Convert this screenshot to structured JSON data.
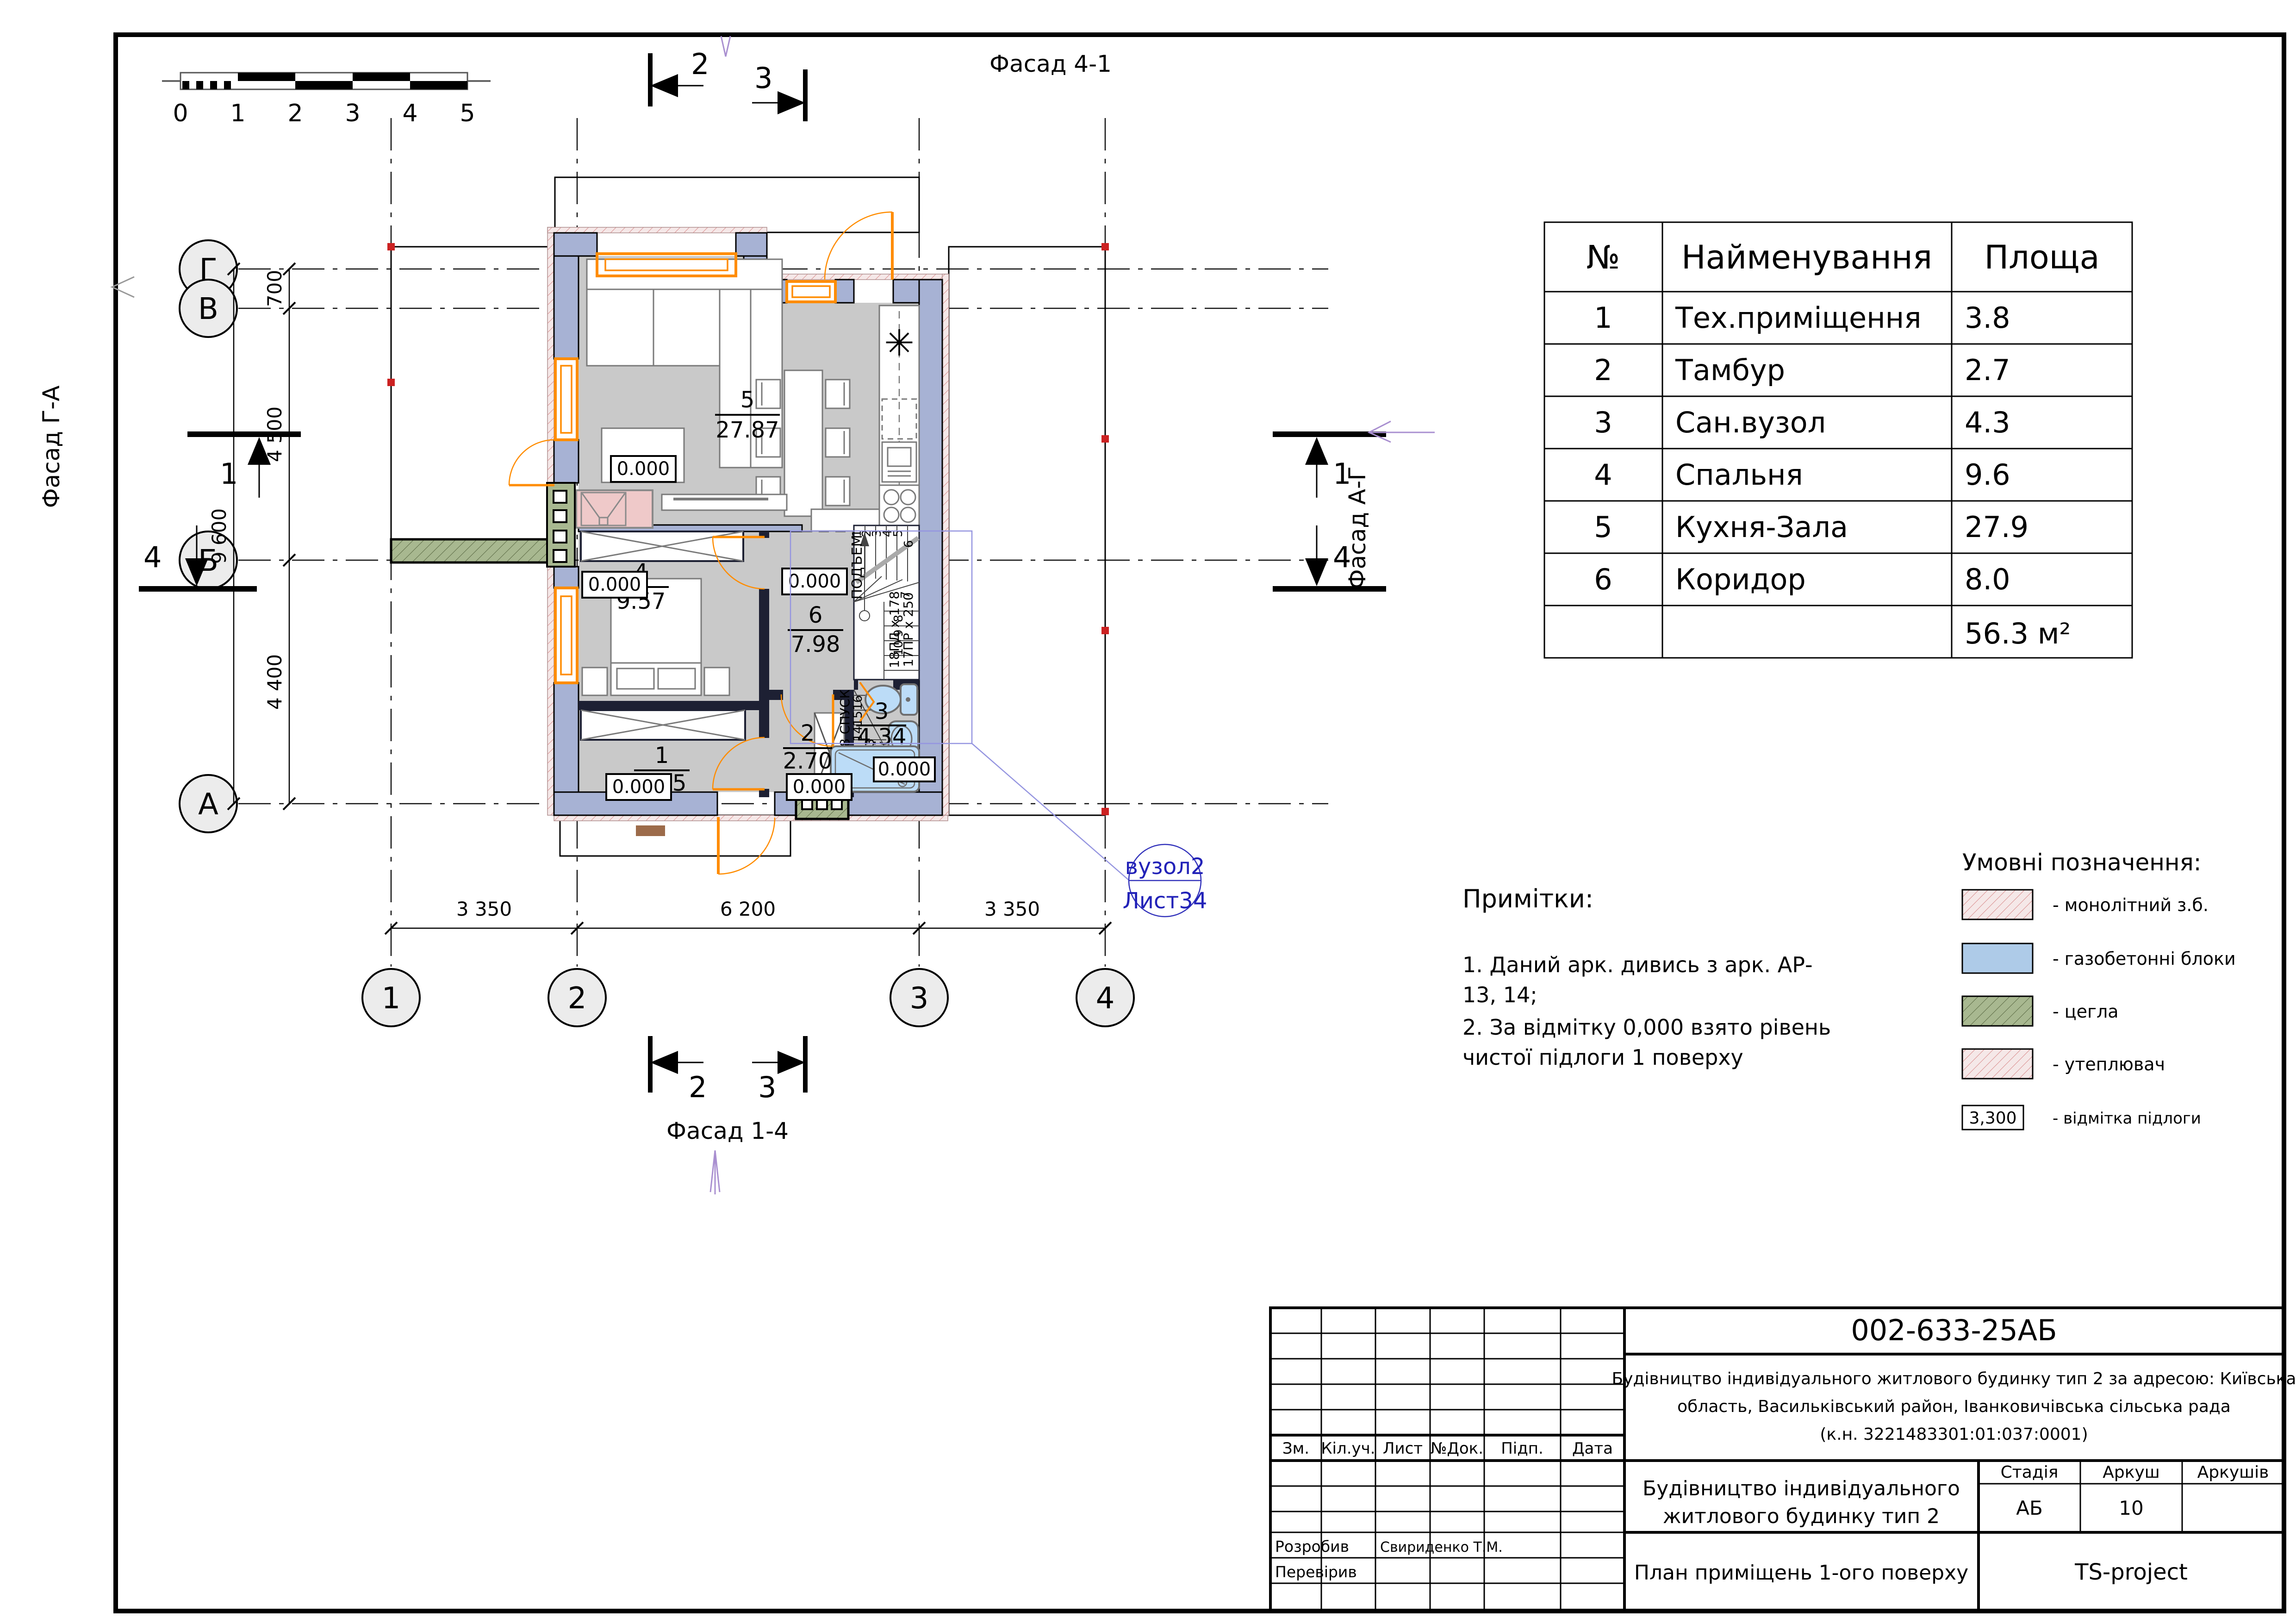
{
  "colors": {
    "wall_blocks": "#a7b2d4",
    "insulation_base": "#f5e8e8",
    "insulation_hatch": "#d98c8c",
    "floor_gray": "#c9c9c9",
    "brick_green": "#a8b890",
    "fixture_blue": "#bcdcf7",
    "fireplace_pink": "#efc9c9",
    "window_orange": "#ff8c00",
    "callout_blue": "#2222b8",
    "marker_red": "#cc2222"
  },
  "scale_bar": {
    "labels": [
      "0",
      "1",
      "2",
      "3",
      "4",
      "5"
    ]
  },
  "room_table": {
    "headers": {
      "num": "№",
      "name": "Найменування",
      "area": "Площа"
    },
    "rows": [
      {
        "num": "1",
        "name": "Тех.приміщення",
        "area": "3.8"
      },
      {
        "num": "2",
        "name": "Тамбур",
        "area": "2.7"
      },
      {
        "num": "3",
        "name": "Сан.вузол",
        "area": "4.3"
      },
      {
        "num": "4",
        "name": "Спальня",
        "area": "9.6"
      },
      {
        "num": "5",
        "name": "Кухня-Зала",
        "area": "27.9"
      },
      {
        "num": "6",
        "name": "Коридор",
        "area": "8.0"
      }
    ],
    "total": "56.3 м²"
  },
  "legend": {
    "title": "Умовні позначення:",
    "items": [
      {
        "label": "- монолітний з.б."
      },
      {
        "label": "- газобетонні блоки"
      },
      {
        "label": "- цегла"
      },
      {
        "label": "- утеплювач"
      },
      {
        "label": "- відмітка підлоги",
        "sample": "3,300"
      }
    ]
  },
  "notes": {
    "title": "Примітки:",
    "lines": [
      "1. Даний арк. дивись з арк. АР-",
      "13, 14;",
      "2. За відмітку 0,000 взято рівень",
      "чистої підлоги 1 поверху"
    ]
  },
  "plan": {
    "level": "0.000",
    "axes": {
      "cols": [
        "1",
        "2",
        "3",
        "4"
      ],
      "rows": [
        "Г",
        "В",
        "Б",
        "А"
      ]
    },
    "dims": {
      "left": [
        "700",
        "4 500",
        "4 400"
      ],
      "left_total": "9 600",
      "bottom": [
        "3 350",
        "6 200",
        "3 350"
      ]
    },
    "facades": {
      "top": "Фасад 4-1",
      "bottom": "Фасад 1-4",
      "left": "Фасад Г-А",
      "right": "Фасад А-Г"
    },
    "sections": {
      "s1": "1",
      "s2": "2",
      "s3": "3",
      "s4": "4"
    },
    "rooms": {
      "r1": {
        "num": "1",
        "area": "3.75"
      },
      "r2": {
        "num": "2",
        "area": "2.70"
      },
      "r3": {
        "num": "3",
        "area": "4.34"
      },
      "r4": {
        "num": "4",
        "area": "9.57"
      },
      "r5": {
        "num": "5",
        "area": "27.87"
      },
      "r6": {
        "num": "6",
        "area": "7.98"
      }
    },
    "stairs": {
      "up": "ПОДЪЕМ",
      "down": "18 СПУСК",
      "rise": "18ПД х 178",
      "run": "17ПР х 250",
      "treads": [
        "1",
        "2",
        "3",
        "4",
        "5",
        "6",
        "7",
        "8",
        "9",
        "10",
        "13",
        "14",
        "15",
        "16"
      ]
    },
    "vuzol": {
      "line1": "вузол2",
      "line2": "Лист34"
    }
  },
  "titleblock": {
    "code": "002-633-25АБ",
    "address": [
      "Будівництво індивідуального житлового будинку тип 2 за адресою: Київська",
      "область, Васильківський район, Іванковичівська сільська рада",
      "(к.н. 3221483301:01:037:0001)"
    ],
    "cols": [
      "Зм.",
      "Кіл.уч.",
      "Лист",
      "№Док.",
      "Підп.",
      "Дата"
    ],
    "object": [
      "Будівництво індивідуального",
      "житлового будинку тип 2"
    ],
    "stage_headers": [
      "Стадія",
      "Аркуш",
      "Аркушів"
    ],
    "stage": "АБ",
    "sheet_no": "10",
    "drawn_label": "Розробив",
    "drawn_name": "Свириденко Т.М.",
    "checked_label": "Перевірив",
    "sheet_title": "План приміщень 1-ого поверху",
    "company": "TS-project"
  }
}
